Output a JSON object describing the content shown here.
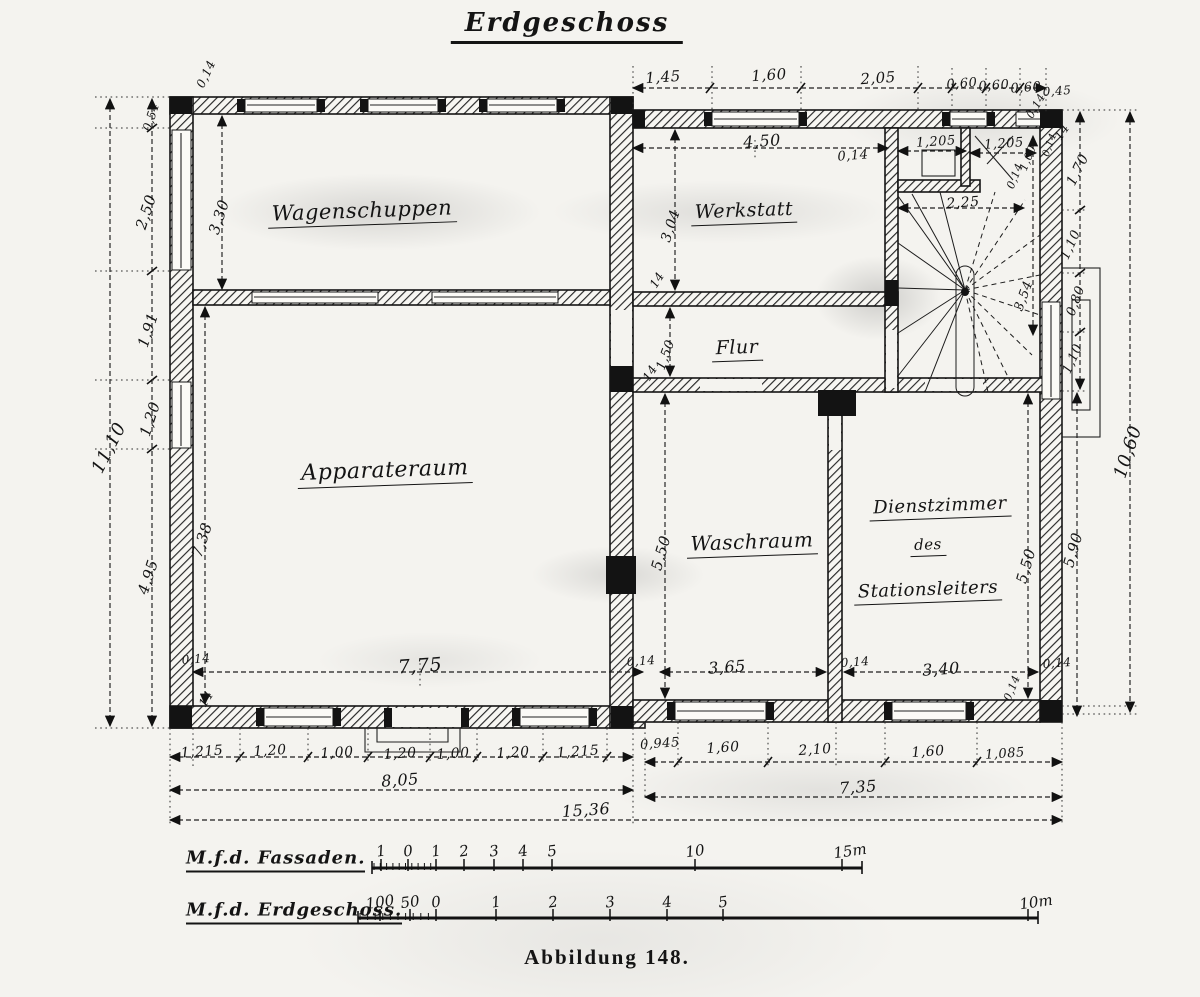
{
  "title": "Erdgeschoss",
  "caption": "Abbildung 148.",
  "rooms": [
    {
      "label": "Wagenschuppen",
      "x": 362,
      "y": 212,
      "s": 21
    },
    {
      "label": "Apparateraum",
      "x": 385,
      "y": 472,
      "s": 22
    },
    {
      "label": "Werkstatt",
      "x": 744,
      "y": 212,
      "s": 19
    },
    {
      "label": "Flur",
      "x": 737,
      "y": 349,
      "s": 19
    },
    {
      "label": "Waschraum",
      "x": 752,
      "y": 543,
      "s": 20
    },
    {
      "label": "Dienstzimmer",
      "x": 940,
      "y": 507,
      "s": 18
    },
    {
      "label": "des",
      "x": 928,
      "y": 546,
      "s": 15
    },
    {
      "label": "Stationsleiters",
      "x": 928,
      "y": 591,
      "s": 18
    }
  ],
  "dimensions": {
    "labels": [
      {
        "t": "1,45",
        "x": 663,
        "y": 77
      },
      {
        "t": "1,60",
        "x": 769,
        "y": 75
      },
      {
        "t": "2,05",
        "x": 878,
        "y": 78
      },
      {
        "t": "0,60",
        "x": 962,
        "y": 84,
        "s": 13
      },
      {
        "t": "0,60",
        "x": 994,
        "y": 86,
        "s": 13
      },
      {
        "t": "0,60",
        "x": 1026,
        "y": 88,
        "s": 13
      },
      {
        "t": "0,45",
        "x": 1057,
        "y": 91,
        "s": 12
      },
      {
        "t": "0,14",
        "x": 1036,
        "y": 106,
        "r": -60,
        "s": 11
      },
      {
        "t": "4,50",
        "x": 762,
        "y": 141,
        "s": 16
      },
      {
        "t": "0,14",
        "x": 853,
        "y": 156,
        "s": 13
      },
      {
        "t": "1,205",
        "x": 936,
        "y": 142,
        "s": 13
      },
      {
        "t": "1,205",
        "x": 1004,
        "y": 144,
        "s": 13
      },
      {
        "t": "1,00",
        "x": 1028,
        "y": 158,
        "r": -68,
        "s": 11
      },
      {
        "t": "0,14",
        "x": 1015,
        "y": 176,
        "r": -68,
        "s": 11
      },
      {
        "t": "14",
        "x": 1062,
        "y": 132,
        "r": -55,
        "s": 12
      },
      {
        "t": "0,14",
        "x": 1050,
        "y": 145,
        "r": -70,
        "s": 10
      },
      {
        "t": "2,25",
        "x": 963,
        "y": 203,
        "s": 14
      },
      {
        "t": "1,70",
        "x": 1078,
        "y": 170,
        "r": -64,
        "s": 14
      },
      {
        "t": "1,10",
        "x": 1071,
        "y": 245,
        "r": -66,
        "s": 13
      },
      {
        "t": "0,80",
        "x": 1076,
        "y": 301,
        "r": -70,
        "s": 13
      },
      {
        "t": "1,10",
        "x": 1073,
        "y": 359,
        "r": -66,
        "s": 13
      },
      {
        "t": "3,54",
        "x": 1024,
        "y": 296,
        "r": -70,
        "s": 13
      },
      {
        "t": "10,60",
        "x": 1128,
        "y": 452,
        "r": -72,
        "s": 18
      },
      {
        "t": "5,90",
        "x": 1073,
        "y": 550,
        "r": -74,
        "s": 15
      },
      {
        "t": "5,50",
        "x": 1026,
        "y": 566,
        "r": -74,
        "s": 15
      },
      {
        "t": "0,14",
        "x": 1057,
        "y": 663,
        "s": 12
      },
      {
        "t": "0,14",
        "x": 1012,
        "y": 688,
        "r": -68,
        "s": 11
      },
      {
        "t": "0,14",
        "x": 206,
        "y": 74,
        "r": -65,
        "s": 12
      },
      {
        "t": "0,54",
        "x": 151,
        "y": 117,
        "r": -72,
        "s": 12
      },
      {
        "t": "2,50",
        "x": 146,
        "y": 212,
        "r": -72,
        "s": 15
      },
      {
        "t": "1,91",
        "x": 148,
        "y": 330,
        "r": -72,
        "s": 15
      },
      {
        "t": "1,20",
        "x": 150,
        "y": 419,
        "r": -72,
        "s": 15
      },
      {
        "t": "11,10",
        "x": 109,
        "y": 448,
        "r": -63,
        "s": 18
      },
      {
        "t": "4,95",
        "x": 148,
        "y": 577,
        "r": -72,
        "s": 15
      },
      {
        "t": "0,14",
        "x": 196,
        "y": 659,
        "s": 12
      },
      {
        "t": "14",
        "x": 206,
        "y": 699,
        "r": -58,
        "s": 12
      },
      {
        "t": "3,30",
        "x": 219,
        "y": 217,
        "r": -72,
        "s": 15
      },
      {
        "t": "7,38",
        "x": 202,
        "y": 540,
        "r": -72,
        "s": 15
      },
      {
        "t": "3,04",
        "x": 671,
        "y": 226,
        "r": -72,
        "s": 14
      },
      {
        "t": "14",
        "x": 657,
        "y": 280,
        "r": -58,
        "s": 12
      },
      {
        "t": "1,50",
        "x": 666,
        "y": 355,
        "r": -70,
        "s": 13
      },
      {
        "t": "14",
        "x": 650,
        "y": 373,
        "r": -58,
        "s": 12
      },
      {
        "t": "5,50",
        "x": 661,
        "y": 553,
        "r": -74,
        "s": 15
      },
      {
        "t": "7,75",
        "x": 420,
        "y": 666,
        "s": 19
      },
      {
        "t": "0,14",
        "x": 641,
        "y": 661,
        "s": 12
      },
      {
        "t": "3,65",
        "x": 727,
        "y": 667,
        "s": 16
      },
      {
        "t": "0,14",
        "x": 855,
        "y": 662,
        "s": 12
      },
      {
        "t": "3,40",
        "x": 941,
        "y": 669,
        "s": 16
      },
      {
        "t": "1,215",
        "x": 202,
        "y": 752,
        "s": 14
      },
      {
        "t": "1,20",
        "x": 270,
        "y": 751,
        "s": 14
      },
      {
        "t": "1,00",
        "x": 337,
        "y": 753,
        "s": 14
      },
      {
        "t": "1,20",
        "x": 400,
        "y": 754,
        "s": 14
      },
      {
        "t": "1,00",
        "x": 453,
        "y": 754,
        "s": 14
      },
      {
        "t": "1,20",
        "x": 513,
        "y": 753,
        "s": 14
      },
      {
        "t": "1,215",
        "x": 578,
        "y": 752,
        "s": 14
      },
      {
        "t": "0,945",
        "x": 660,
        "y": 744,
        "s": 13
      },
      {
        "t": "1,60",
        "x": 723,
        "y": 748,
        "s": 14
      },
      {
        "t": "2,10",
        "x": 815,
        "y": 750,
        "s": 14
      },
      {
        "t": "1,60",
        "x": 928,
        "y": 752,
        "s": 14
      },
      {
        "t": "1,085",
        "x": 1005,
        "y": 754,
        "s": 13
      },
      {
        "t": "8,05",
        "x": 400,
        "y": 780,
        "s": 16
      },
      {
        "t": "7,35",
        "x": 858,
        "y": 787,
        "s": 16
      },
      {
        "t": "15,36",
        "x": 586,
        "y": 810,
        "s": 16
      }
    ]
  },
  "scales": [
    {
      "label": "M.f.d. Fassaden.",
      "lx": 186,
      "ly": 860,
      "bar": {
        "x1": 372,
        "x2": 862,
        "y": 868
      },
      "ty": 851,
      "ticks": [
        {
          "t": "1",
          "x": 381
        },
        {
          "t": "0",
          "x": 408
        },
        {
          "t": "1",
          "x": 436
        },
        {
          "t": "2",
          "x": 464
        },
        {
          "t": "3",
          "x": 494
        },
        {
          "t": "4",
          "x": 523
        },
        {
          "t": "5",
          "x": 552
        },
        {
          "t": "10",
          "x": 695
        },
        {
          "t": "15m",
          "x": 842
        }
      ]
    },
    {
      "label": "M.f.d. Erdgeschoss.",
      "lx": 186,
      "ly": 912,
      "bar": {
        "x1": 358,
        "x2": 1038,
        "y": 918
      },
      "ty": 902,
      "ticks": [
        {
          "t": "100",
          "x": 380
        },
        {
          "t": "50",
          "x": 410
        },
        {
          "t": "0",
          "x": 436
        },
        {
          "t": "1",
          "x": 496
        },
        {
          "t": "2",
          "x": 553
        },
        {
          "t": "3",
          "x": 610
        },
        {
          "t": "4",
          "x": 667
        },
        {
          "t": "5",
          "x": 723
        },
        {
          "t": "10m",
          "x": 1028
        }
      ]
    }
  ]
}
